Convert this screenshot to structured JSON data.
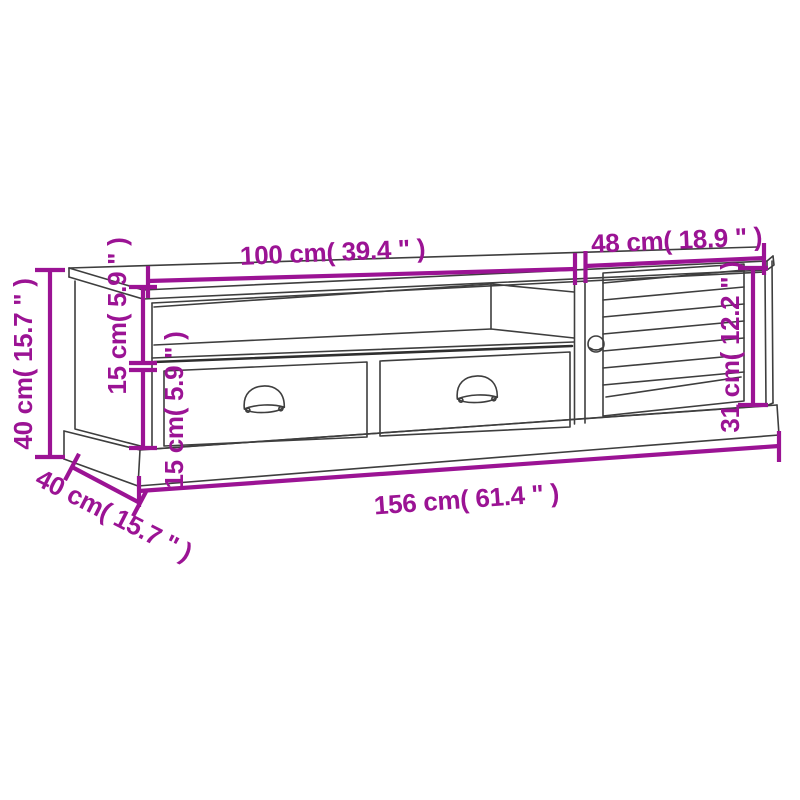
{
  "page": {
    "type": "product-dimension-diagram",
    "subject": "TV cabinet line drawing with open shelf, two drawers with cup handles, louvered door and plinth base",
    "background_color": "#ffffff"
  },
  "style": {
    "dimension_color": "#9b1394",
    "line_art_color": "#3e3e3e"
  },
  "dimensions": {
    "left_section_width": "100 cm( 39.4 \" )",
    "right_section_width": "48 cm( 18.9 \" )",
    "overall_height": "40 cm( 15.7 \" )",
    "open_shelf_height": "15 cm( 5.9 \" )",
    "drawer_section_height": "15 cm( 5.9 \" )",
    "door_opening_height": "31 cm( 12.2 \" )",
    "overall_width": "156 cm( 61.4 \" )",
    "depth": "40 cm( 15.7 \" )"
  }
}
